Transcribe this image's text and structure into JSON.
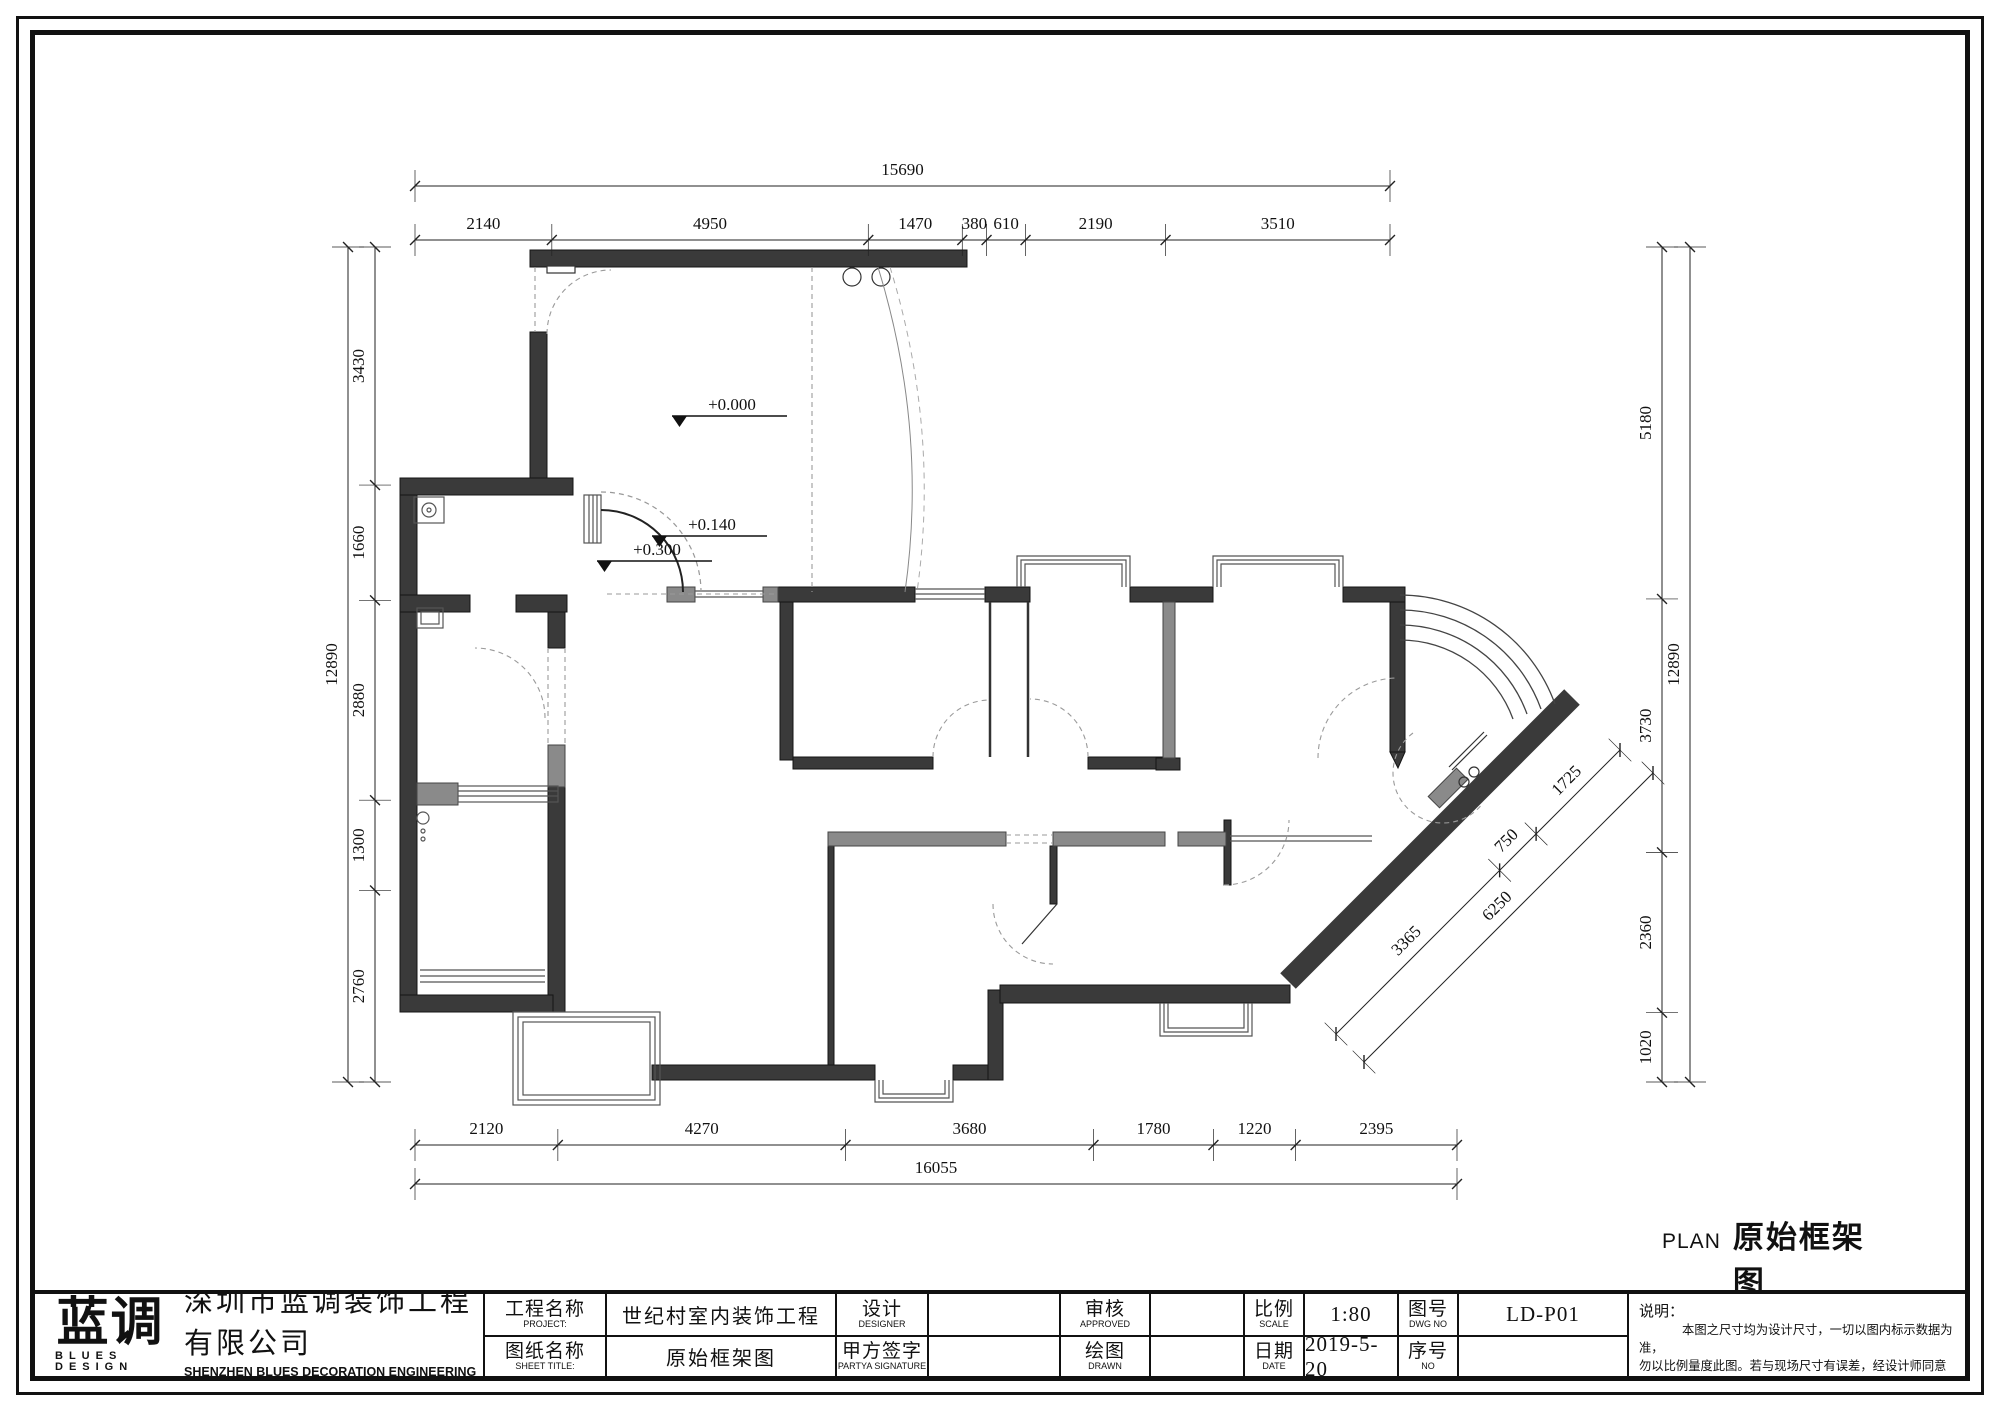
{
  "colors": {
    "wall": "#3a3a3a",
    "gray_wall": "#8a8a8a",
    "line": "#111111",
    "dash": "#999999",
    "paper": "#ffffff"
  },
  "plan_caption": {
    "tag": "PLAN",
    "title": "原始框架图",
    "scale": "SCALL 1:80"
  },
  "levels": [
    {
      "label": "+0.000"
    },
    {
      "label": "+0.140"
    },
    {
      "label": "+0.300"
    }
  ],
  "dimensions": {
    "top": {
      "overall": "15690",
      "segments": [
        "2140",
        "4950",
        "1470",
        "380",
        "610",
        "2190",
        "3510"
      ]
    },
    "bottom": {
      "overall": "16055",
      "segments": [
        "2120",
        "4270",
        "3680",
        "1780",
        "1220",
        "2395"
      ]
    },
    "left": {
      "overall": "12890",
      "segments": [
        "3430",
        "1660",
        "2880",
        "1300",
        "2760"
      ]
    },
    "right": {
      "overall": "12890",
      "segments": [
        "5180",
        "3730",
        "2360",
        "1020"
      ]
    },
    "diagonal": {
      "overall": "6250",
      "segments": [
        "3365",
        "750",
        "1725"
      ]
    }
  },
  "title_block": {
    "logo_cn": "蓝调",
    "logo_en": "BLUES DESIGN",
    "company_cn": "深圳市蓝调装饰工程有限公司",
    "company_en": "SHENZHEN BLUES DECORATION  ENGINEERING CO., LTD",
    "project_label_cn": "工程名称",
    "project_label_en": "PROJECT:",
    "project_value": "世纪村室内装饰工程",
    "sheet_label_cn": "图纸名称",
    "sheet_label_en": "SHEET TITLE:",
    "sheet_value": "原始框架图",
    "designer_label_cn": "设计",
    "designer_label_en": "DESIGNER",
    "designer_value": "",
    "partya_label_cn": "甲方签字",
    "partya_label_en": "PARTYA SIGNATURE",
    "partya_value": "",
    "approved_label_cn": "审核",
    "approved_label_en": "APPROVED",
    "approved_value": "",
    "drawn_label_cn": "绘图",
    "drawn_label_en": "DRAWN",
    "drawn_value": "",
    "scale_label_cn": "比例",
    "scale_label_en": "SCALE",
    "scale_value": "1:80",
    "date_label_cn": "日期",
    "date_label_en": "DATE",
    "date_value": "2019-5-20",
    "dwgno_label_cn": "图号",
    "dwgno_label_en": "DWG NO",
    "dwgno_value": "LD-P01",
    "no_label_cn": "序号",
    "no_label_en": "NO",
    "no_value": ""
  },
  "notes": {
    "title": "说明：",
    "lines": [
      "本图之尺寸均为设计尺寸，一切以图内标示数据为准，",
      "勿以比例量度此图。若与现场尺寸有误差，经设计师同意后，可根",
      "据现场情况作相应调整。承建人必须核对图纸,如发现问题，应立",
      "即通知本公司，未经本公司同意不得将此图翻印。"
    ]
  }
}
